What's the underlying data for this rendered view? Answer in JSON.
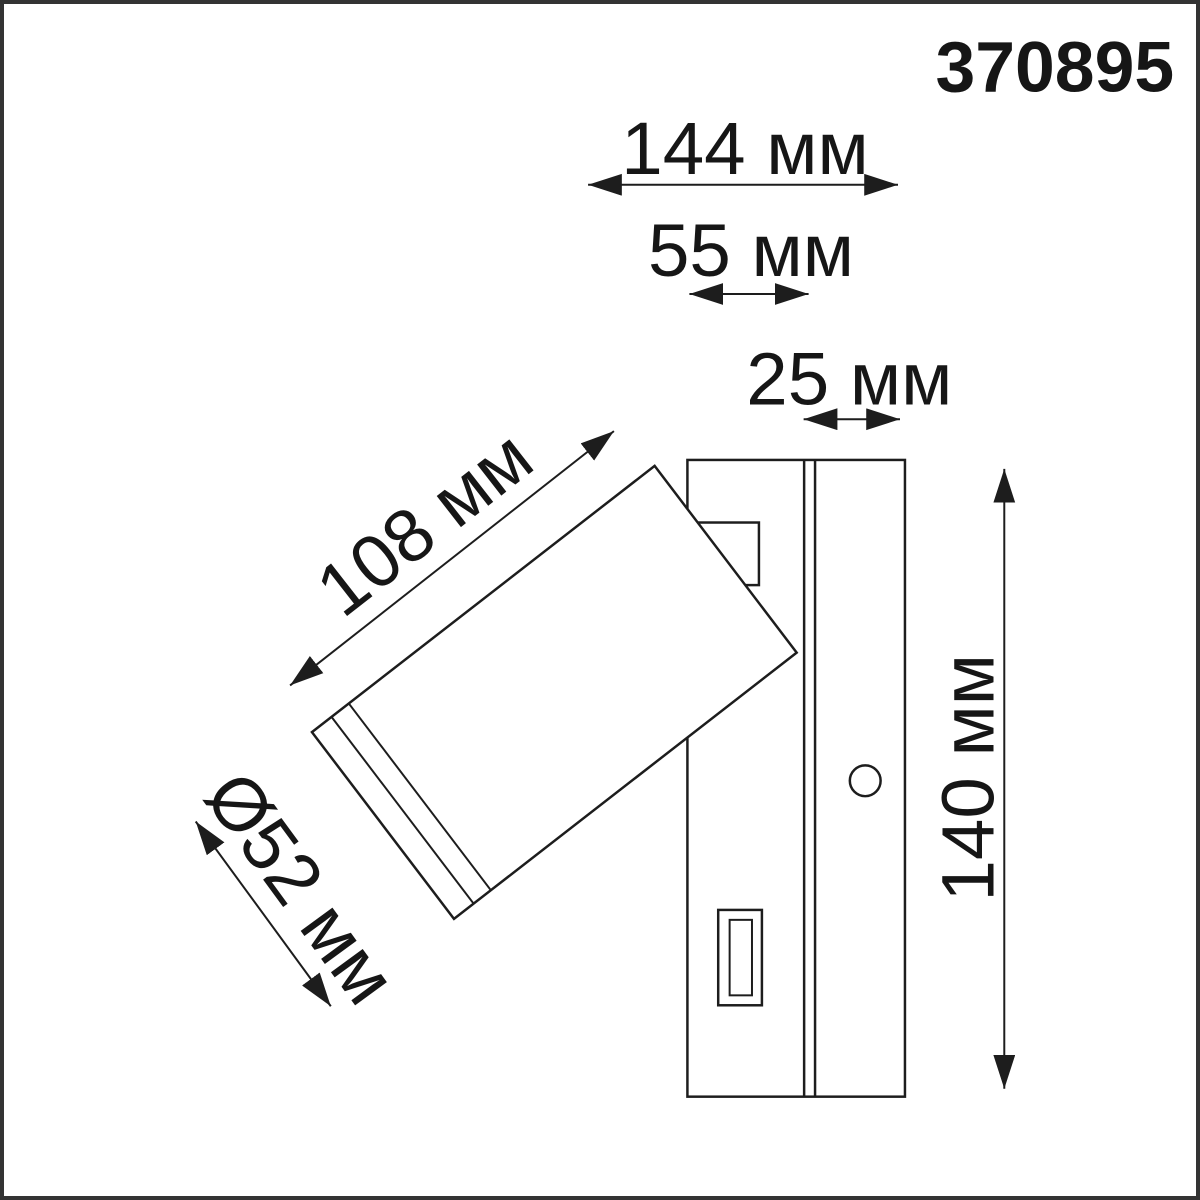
{
  "product_code": "370895",
  "colors": {
    "line": "#1d1d1d",
    "text": "#161616",
    "frame": "#333333",
    "background": "#ffffff"
  },
  "dimensions": {
    "total_width": "144 мм",
    "plate_width": "55 мм",
    "plate_depth": "25 мм",
    "head_length": "108 мм",
    "head_diameter": "Ø52 мм",
    "plate_height": "140 мм"
  }
}
